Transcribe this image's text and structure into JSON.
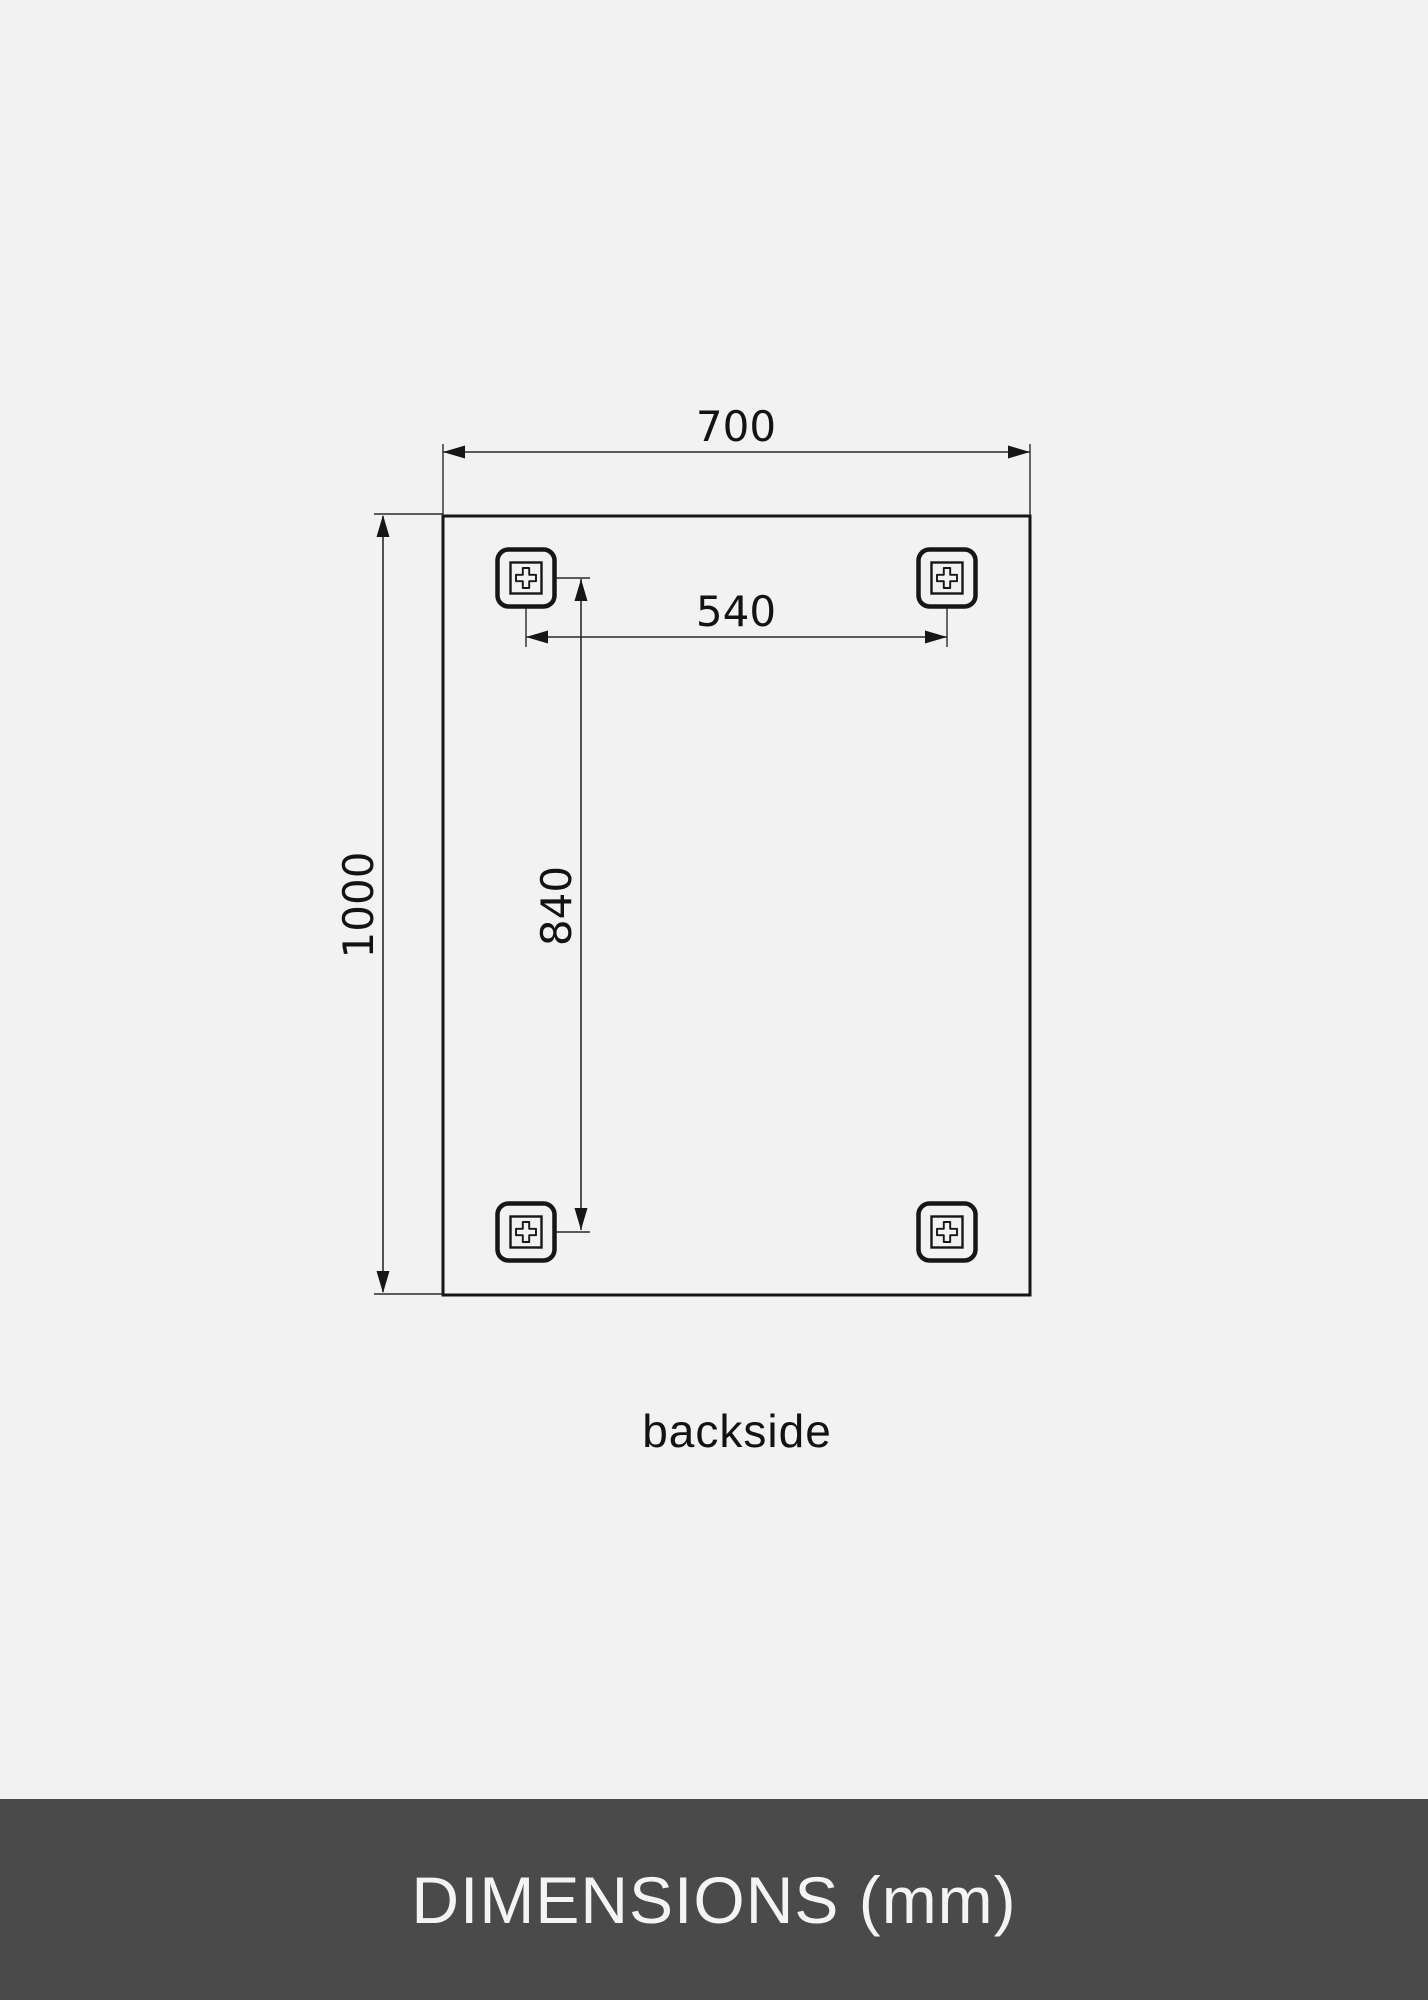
{
  "diagram": {
    "dimension_labels": {
      "width": "700",
      "height": "1000",
      "bracket_spacing_horizontal": "540",
      "bracket_spacing_vertical": "840"
    },
    "view_label": "backside",
    "units": "mm"
  },
  "footer": {
    "title": "DIMENSIONS (mm)"
  },
  "icons": {
    "screw_cross": "plus-cross mounting screw icon",
    "arrowhead": "dimension arrowhead"
  },
  "colors": {
    "background": "#f2f2f2",
    "line": "#161616",
    "footer_background": "#4a4a4a",
    "footer_text": "#f4f4f4"
  }
}
